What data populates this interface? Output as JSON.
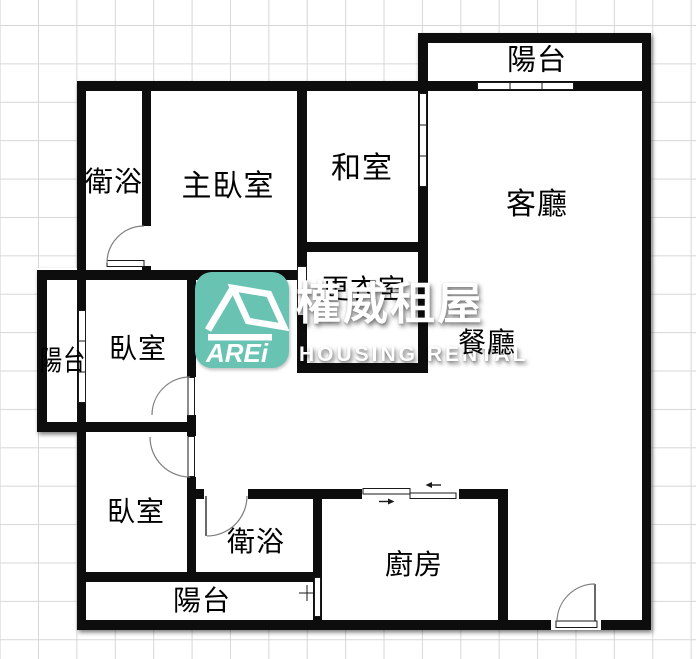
{
  "brand": {
    "abbrev": "AREi",
    "name_zh": "權威租屋",
    "name_en": "HOUSING RENTAL",
    "logo_color": "#69c3b3"
  },
  "rooms": [
    {
      "id": "balcony-top",
      "label": "陽台",
      "x": 537,
      "y": 61,
      "size": 29
    },
    {
      "id": "bathroom-upper",
      "label": "衛浴",
      "x": 114,
      "y": 183,
      "size": 28
    },
    {
      "id": "master-bedroom",
      "label": "主臥室",
      "x": 228,
      "y": 187,
      "size": 30
    },
    {
      "id": "tatami-room",
      "label": "和室",
      "x": 362,
      "y": 169,
      "size": 30
    },
    {
      "id": "living-room",
      "label": "客廳",
      "x": 537,
      "y": 205,
      "size": 30
    },
    {
      "id": "walk-in-closet",
      "label": "更衣室",
      "x": 364,
      "y": 290,
      "size": 27
    },
    {
      "id": "dining-room",
      "label": "餐廳",
      "x": 487,
      "y": 344,
      "size": 28
    },
    {
      "id": "balcony-left",
      "label": "陽台",
      "x": 63,
      "y": 362,
      "size": 28,
      "sx": 0.8
    },
    {
      "id": "bedroom-middle",
      "label": "臥室",
      "x": 138,
      "y": 350,
      "size": 28
    },
    {
      "id": "bedroom-lower",
      "label": "臥室",
      "x": 136,
      "y": 513,
      "size": 28
    },
    {
      "id": "bathroom-lower",
      "label": "衛浴",
      "x": 256,
      "y": 543,
      "size": 28
    },
    {
      "id": "kitchen",
      "label": "廚房",
      "x": 414,
      "y": 566,
      "size": 28
    },
    {
      "id": "balcony-bottom",
      "label": "陽台",
      "x": 202,
      "y": 602,
      "size": 28
    }
  ],
  "colors": {
    "wall": "#0a0a0a",
    "grid_line": "#d7d7d7",
    "floor": "#ffffff",
    "accent_teal": "#69c3b3"
  }
}
